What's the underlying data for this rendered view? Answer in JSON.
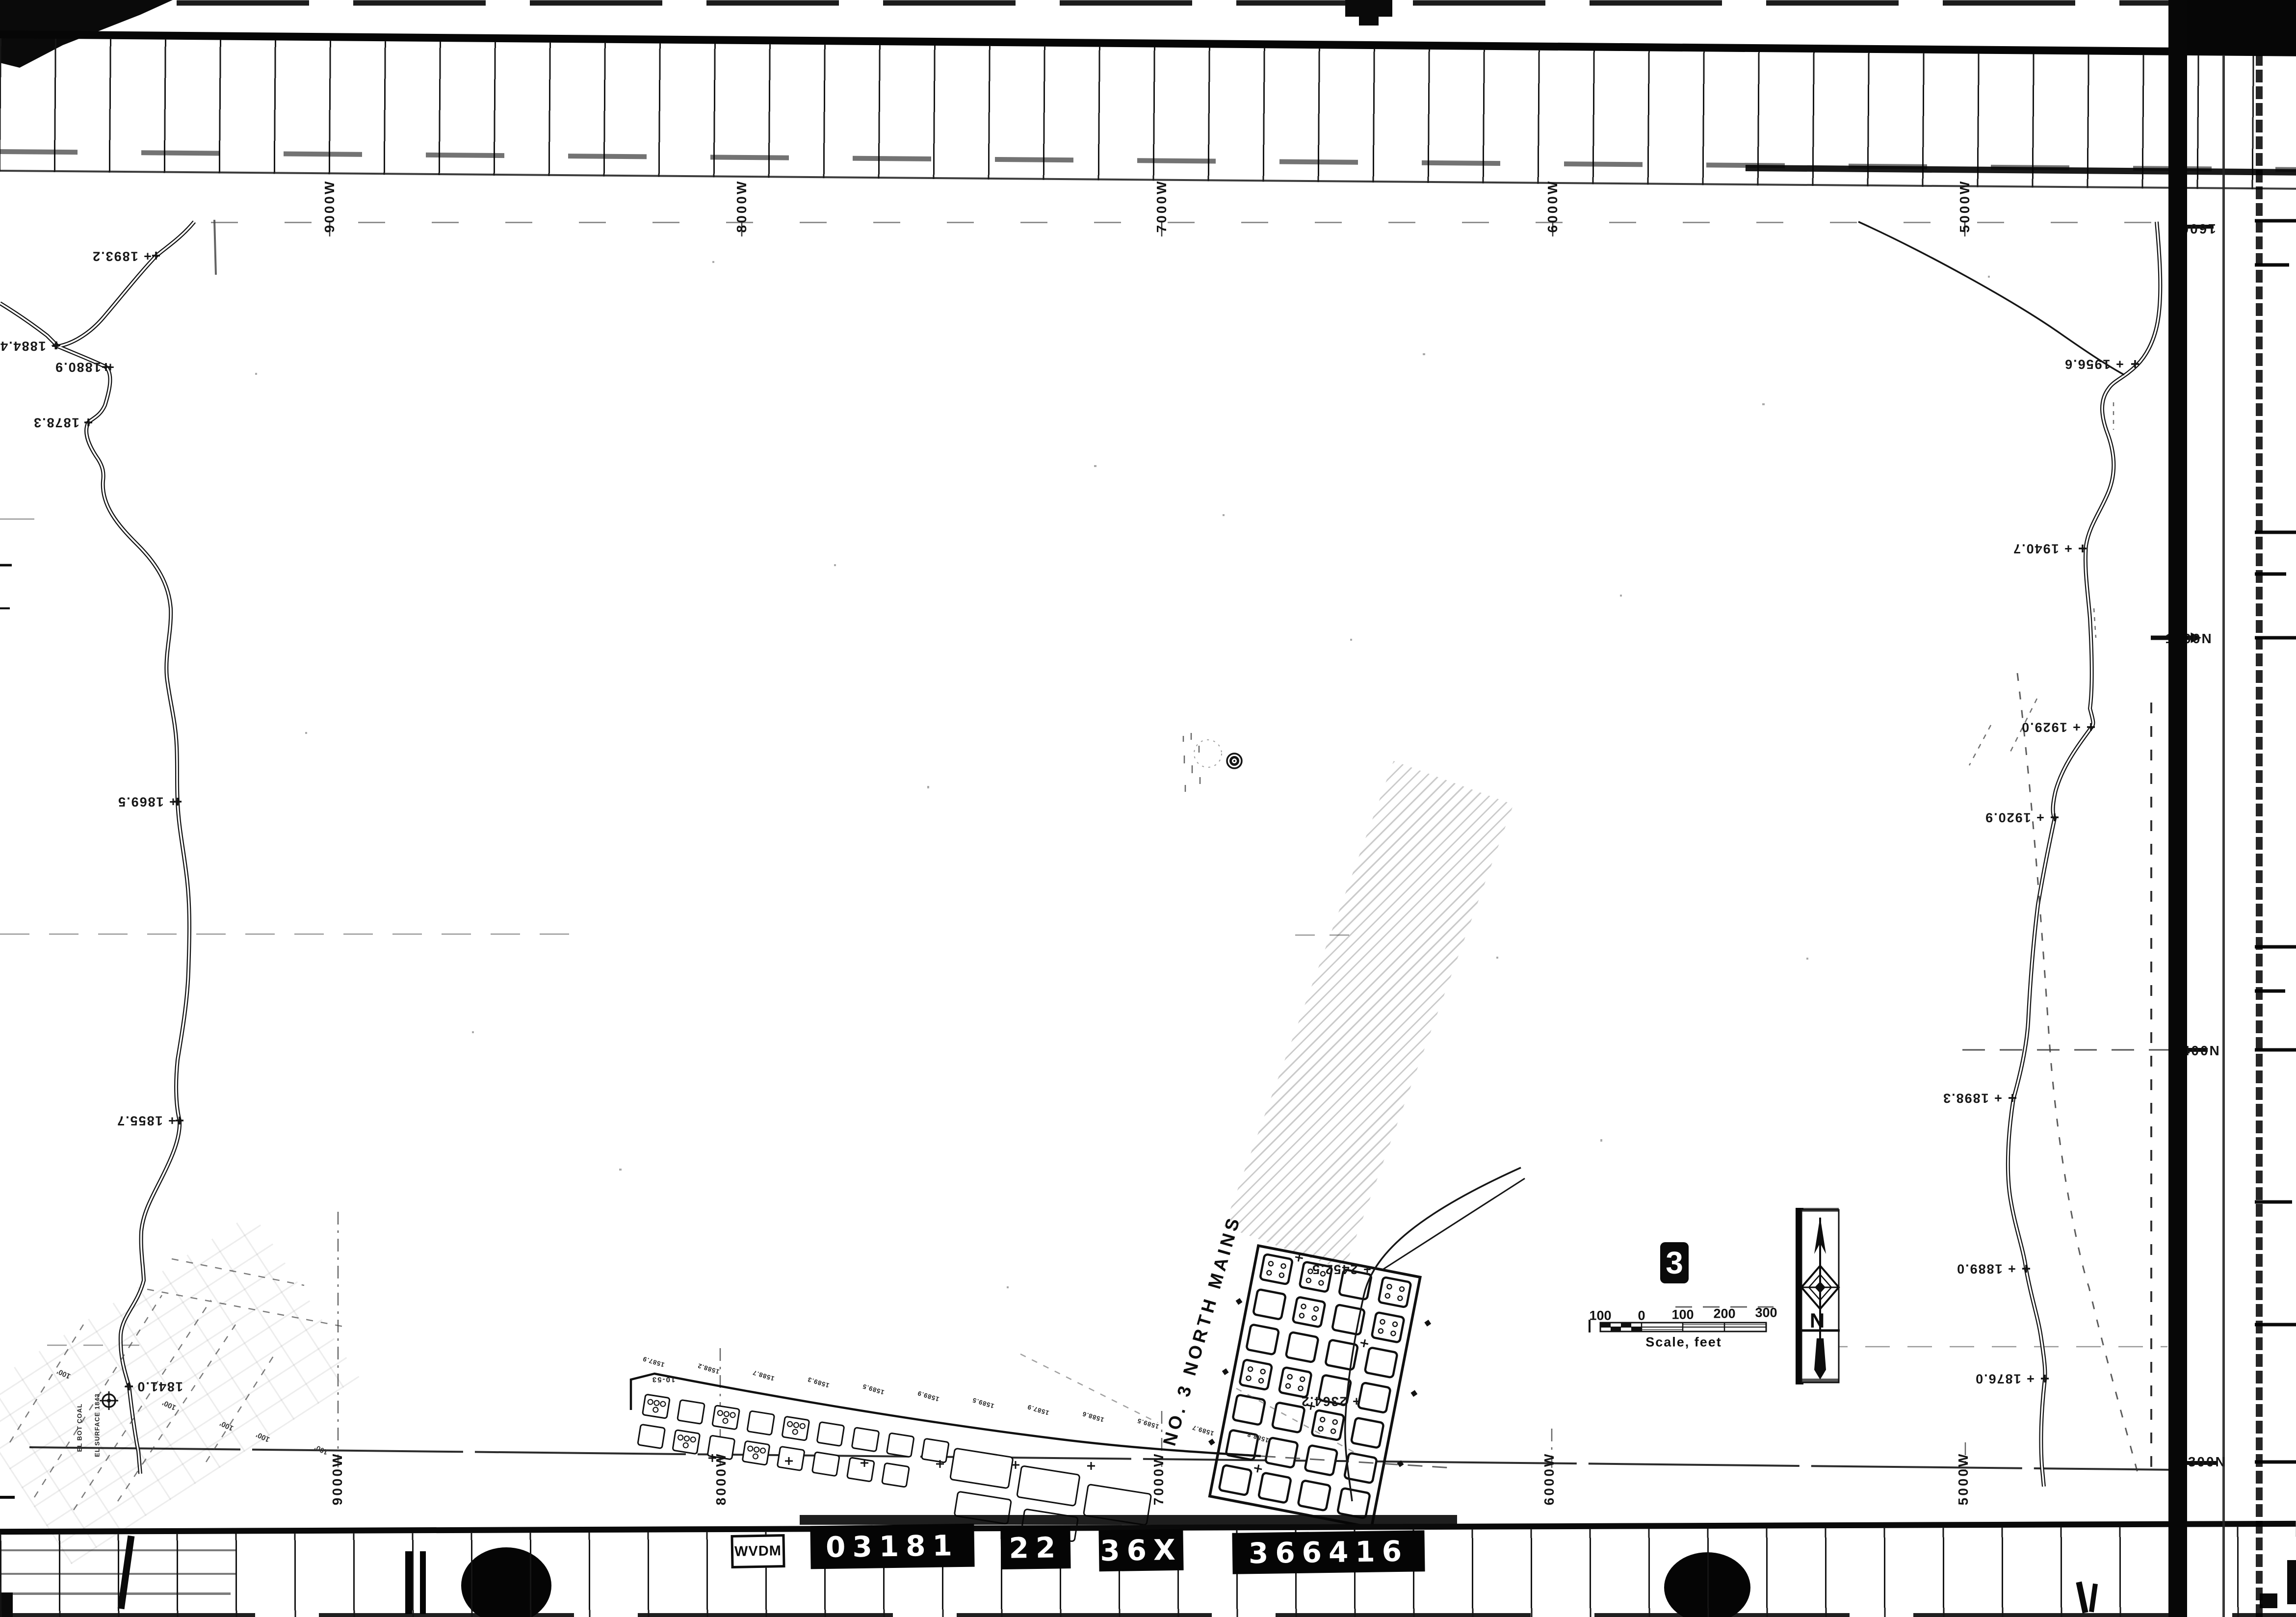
{
  "film": {
    "agency_label": "WVDM",
    "id_boxes": [
      "03181",
      "22",
      "36X",
      "366416"
    ]
  },
  "grid": {
    "top_west_labels": [
      "9000W",
      "8000W",
      "7000W",
      "6000W",
      "5000W"
    ],
    "bottom_west_labels": [
      "9000W",
      "8000W",
      "7000W",
      "6000W",
      "5000W"
    ],
    "right_north_labels": [
      "1600N",
      "1500N",
      "1400N",
      "1300N"
    ]
  },
  "left_stream_spots": [
    "+ 1893.2",
    "+ 1884.4",
    "+ 1880.9",
    "+ 1878.3",
    "+ 1869.5",
    "+ 1855.7",
    "1841.0 +"
  ],
  "right_stream_spots": [
    "+ 1956.6",
    "+ 1940.7",
    "+ 1929.0",
    "+ 1920.9",
    "+ 1898.3",
    "+ 1889.0",
    "+ 1876.0"
  ],
  "workings_main": {
    "title": "NO. 3 NORTH MAINS",
    "spot_a": "+ 2452.5",
    "spot_b": "+ 2364.2"
  },
  "workings_south": {
    "corner_label": "10-53",
    "seam_elevations": [
      "1587.9",
      "1588.2",
      "1588.7",
      "1589.3",
      "1589.5",
      "1589.9",
      "1589.5",
      "1587.9",
      "1588.6",
      "1589.5",
      "1589.7",
      "1588.8"
    ]
  },
  "drill_annotations": {
    "line_a": "EL SURFACE 1843",
    "line_b": "EL BOT COAL",
    "distance_marks": [
      "100'",
      "100'",
      "100'",
      "100'",
      "100'"
    ]
  },
  "scale_bar": {
    "tick_labels": [
      "100",
      "0",
      "100",
      "200",
      "300"
    ],
    "caption": "Scale, feet"
  },
  "north_arrow_letter": "N",
  "sheet_number": "3",
  "colors": {
    "ink": "#111111",
    "paper": "#ffffff"
  }
}
